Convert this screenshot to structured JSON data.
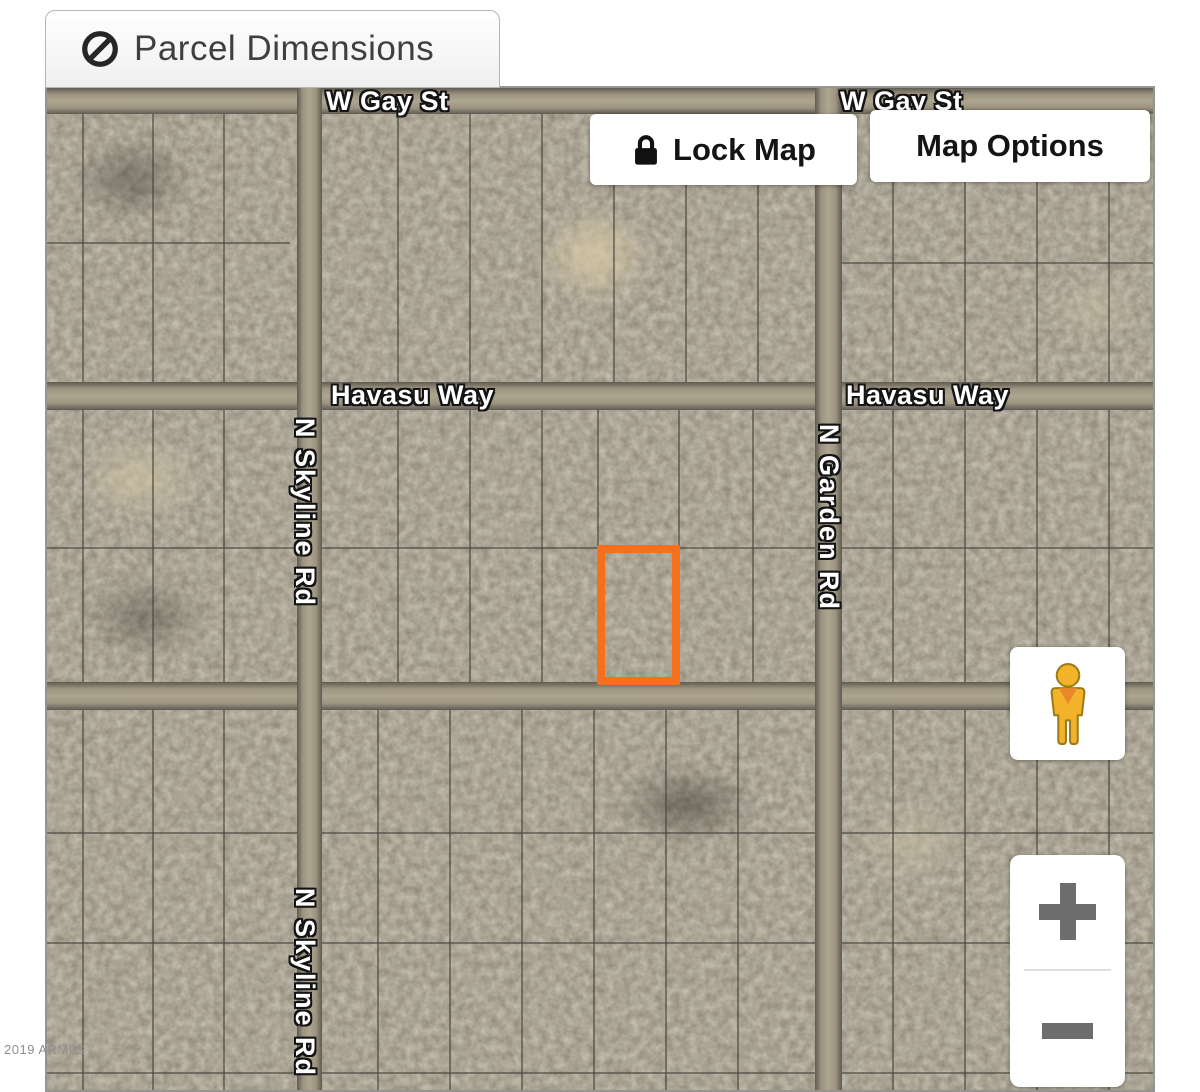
{
  "tab": {
    "label": "Parcel Dimensions",
    "icon": "no-symbol-icon"
  },
  "toolbar": {
    "lock_map_label": "Lock Map",
    "lock_icon": "lock-icon",
    "map_options_label": "Map Options"
  },
  "map": {
    "type": "satellite-parcel-map",
    "street_labels": [
      {
        "text": "W Gay St",
        "orientation": "horizontal"
      },
      {
        "text": "W Gay St",
        "orientation": "horizontal"
      },
      {
        "text": "Havasu Way",
        "orientation": "horizontal"
      },
      {
        "text": "Havasu Way",
        "orientation": "horizontal"
      },
      {
        "text": "N Skyline Rd",
        "orientation": "vertical"
      },
      {
        "text": "N Garden Rd",
        "orientation": "vertical"
      },
      {
        "text": "N Skyline Rd",
        "orientation": "vertical"
      }
    ],
    "parcel": {
      "highlighted": true,
      "outline_color": "#F4701D"
    },
    "watermark": "2019 ARMLS",
    "colors": {
      "parcel_highlight": "#F4701D",
      "terrain_base": "#8A8273",
      "road_fill": "#AEA590",
      "label_fill": "#FFFFFF",
      "pegman_yellow": "#F2B32A",
      "control_gray": "#6D6D6D"
    }
  },
  "controls": {
    "pegman": "street-view-pegman",
    "zoom_in": "+",
    "zoom_out": "−"
  }
}
